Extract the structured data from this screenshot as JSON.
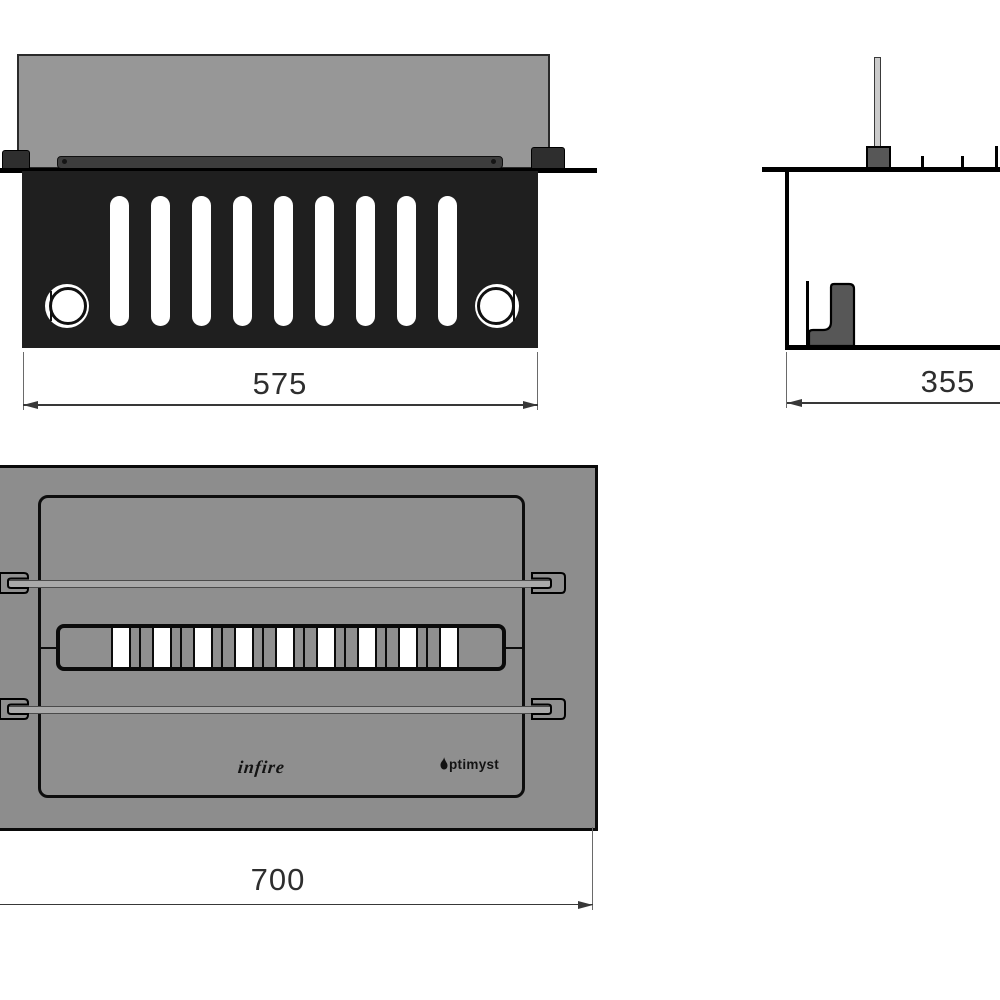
{
  "drawing": {
    "title": "fireplace-insert-technical-drawing",
    "views": {
      "front": {
        "dimension_width": "575",
        "slot_count": 9
      },
      "side": {
        "dimension_depth": "355"
      },
      "top": {
        "dimension_width": "700",
        "slot_count": 9,
        "brand_left": "infire",
        "brand_right": "ptimyst",
        "brand_right_full": "Optimyst"
      }
    },
    "colors": {
      "body": "#1f1f1f",
      "glass": "#979797",
      "plate": "#8d8d8d",
      "bracket": "#575757",
      "line": "#0d0d0d"
    }
  }
}
